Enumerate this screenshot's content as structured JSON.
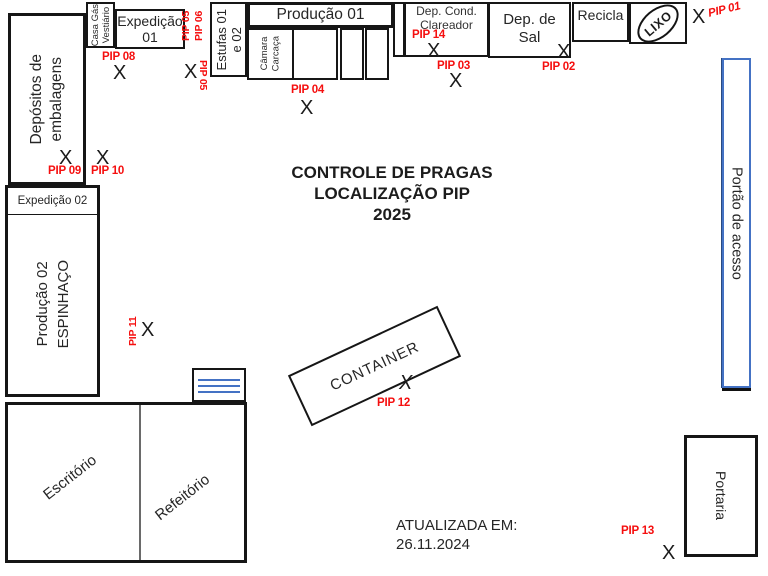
{
  "header": {
    "title_line1": "CONTROLE DE PRAGAS",
    "title_line2": "LOCALIZAÇÃO PIP",
    "title_line3": "2025"
  },
  "footer": {
    "updated_label": "ATUALIZADA EM:",
    "updated_date": "26.11.2024"
  },
  "rooms": {
    "depositos": {
      "line1": "Depósitos de",
      "line2": "embalagens"
    },
    "casa_gas": {
      "line1": "Casa Gás",
      "line2": "Vestiário"
    },
    "expedicao01": {
      "line1": "Expedição",
      "line2": "01"
    },
    "estufas": {
      "line1": "Estufas 01",
      "line2": "e 02"
    },
    "producao01": {
      "label": "Produção 01"
    },
    "camara": {
      "line1": "Câmara",
      "line2": "Carcaça"
    },
    "dep_cond": {
      "line1": "Dep. Cond.",
      "line2": "Clareador"
    },
    "dep_sal": {
      "line1": "Dep. de",
      "line2": "Sal"
    },
    "recicla": {
      "label": "Recicla"
    },
    "lixo": {
      "label": "LIXO"
    },
    "portao": {
      "label": "Portão de acesso"
    },
    "expedicao02": {
      "header": "Expedição 02",
      "line1": "Produção 02",
      "line2": "ESPINHAÇO"
    },
    "escritorio": {
      "label": "Escritório"
    },
    "refeitorio": {
      "label": "Refeitório"
    },
    "container": {
      "label": "CONTAINER"
    },
    "portaria": {
      "label": "Portaria"
    }
  },
  "pips": {
    "p01": {
      "label": "PIP 01",
      "marker": "X"
    },
    "p02": {
      "label": "PIP 02",
      "marker": "X"
    },
    "p03": {
      "label": "PIP 03",
      "marker": "X"
    },
    "p04": {
      "label": "PIP 04",
      "marker": "X"
    },
    "p05": {
      "label": "PIP 05"
    },
    "p05x": {
      "label": "PIP 05",
      "marker": "X"
    },
    "p06": {
      "label": "PIP 06"
    },
    "p08": {
      "label": "PIP 08",
      "marker": "X"
    },
    "p09": {
      "label": "PIP 09",
      "marker": "X"
    },
    "p10": {
      "label": "PIP 10",
      "marker": "X"
    },
    "p11": {
      "label": "PIP 11",
      "marker": "X"
    },
    "p12": {
      "label": "PIP 12",
      "marker": "X"
    },
    "p13": {
      "label": "PIP 13",
      "marker": "X"
    },
    "p14": {
      "label": "PIP 14",
      "marker": "X"
    }
  },
  "colors": {
    "pip_red": "#F50F0F",
    "gate_blue": "#4472C4",
    "wall": "#161616"
  }
}
